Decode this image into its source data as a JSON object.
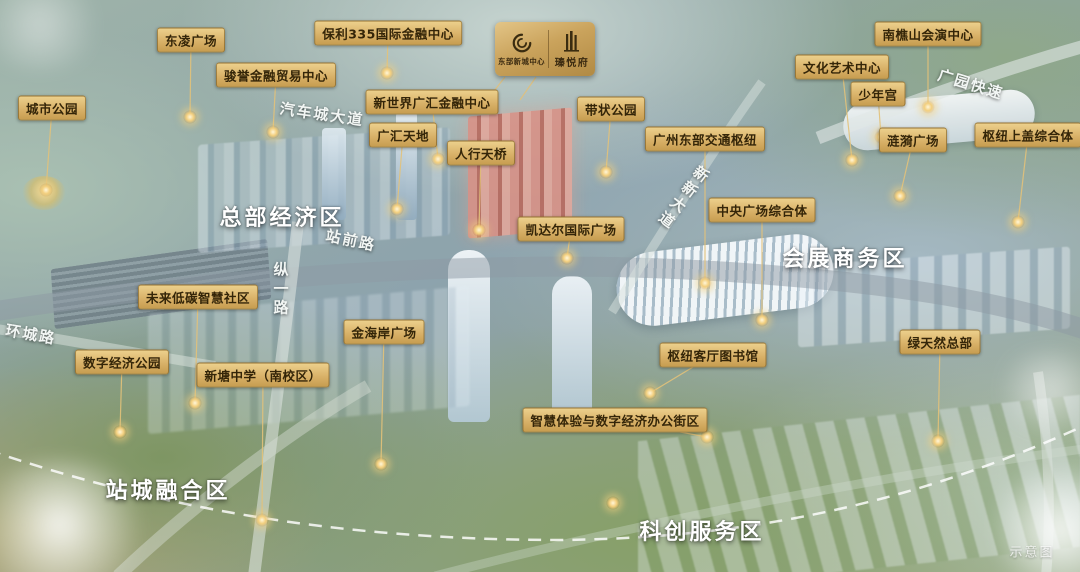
{
  "watermark": "示意图",
  "badge": {
    "left_name": "东部新城中心",
    "right_name": "瑧悦府"
  },
  "zones": [
    {
      "label": "总部经济区",
      "x": 282,
      "y": 216
    },
    {
      "label": "会展商务区",
      "x": 845,
      "y": 257
    },
    {
      "label": "站城融合区",
      "x": 168,
      "y": 489
    },
    {
      "label": "科创服务区",
      "x": 702,
      "y": 530
    }
  ],
  "roads": [
    {
      "label": "汽车城大道",
      "x": 322,
      "y": 114,
      "rotate": 8,
      "vertical": false
    },
    {
      "label": "站前路",
      "x": 351,
      "y": 240,
      "rotate": 12,
      "vertical": false
    },
    {
      "label": "纵一路",
      "x": 281,
      "y": 290,
      "rotate": 0,
      "vertical": true
    },
    {
      "label": "环城路",
      "x": 31,
      "y": 334,
      "rotate": 10,
      "vertical": false
    },
    {
      "label": "广园快速",
      "x": 971,
      "y": 84,
      "rotate": 17,
      "vertical": false
    },
    {
      "label": "新新大道",
      "x": 683,
      "y": 198,
      "rotate": 37,
      "vertical": true
    }
  ],
  "landmarks": [
    {
      "label": "城市公园",
      "lx": 52,
      "ly": 108,
      "dx": 46,
      "dy": 190
    },
    {
      "label": "东凌广场",
      "lx": 191,
      "ly": 40,
      "dx": 190,
      "dy": 117
    },
    {
      "label": "骏誉金融贸易中心",
      "lx": 276,
      "ly": 75,
      "dx": 273,
      "dy": 132
    },
    {
      "label": "保利335国际金融中心",
      "lx": 388,
      "ly": 33,
      "dx": 387,
      "dy": 73
    },
    {
      "label": "新世界广汇金融中心",
      "lx": 432,
      "ly": 102,
      "dx": 438,
      "dy": 159
    },
    {
      "label": "广汇天地",
      "lx": 403,
      "ly": 135,
      "dx": 397,
      "dy": 209
    },
    {
      "label": "人行天桥",
      "lx": 481,
      "ly": 153,
      "dx": 479,
      "dy": 230
    },
    {
      "label": "带状公园",
      "lx": 611,
      "ly": 109,
      "dx": 606,
      "dy": 172
    },
    {
      "label": "广州东部交通枢纽",
      "lx": 705,
      "ly": 139,
      "dx": 705,
      "dy": 283
    },
    {
      "label": "凯达尔国际广场",
      "lx": 571,
      "ly": 229,
      "dx": 567,
      "dy": 258
    },
    {
      "label": "中央广场综合体",
      "lx": 762,
      "ly": 210,
      "dx": 762,
      "dy": 320
    },
    {
      "label": "文化艺术中心",
      "lx": 842,
      "ly": 67,
      "dx": 852,
      "dy": 160
    },
    {
      "label": "南樵山会演中心",
      "lx": 928,
      "ly": 34,
      "dx": 928,
      "dy": 107
    },
    {
      "label": "少年宫",
      "lx": 878,
      "ly": 94,
      "dx": 881,
      "dy": 137
    },
    {
      "label": "涟漪广场",
      "lx": 913,
      "ly": 140,
      "dx": 900,
      "dy": 196
    },
    {
      "label": "枢纽上盖综合体",
      "lx": 1028,
      "ly": 135,
      "dx": 1018,
      "dy": 222
    },
    {
      "label": "未来低碳智慧社区",
      "lx": 198,
      "ly": 297,
      "dx": 195,
      "dy": 403
    },
    {
      "label": "数字经济公园",
      "lx": 122,
      "ly": 362,
      "dx": 120,
      "dy": 432
    },
    {
      "label": "新塘中学（南校区）",
      "lx": 263,
      "ly": 375,
      "dx": 262,
      "dy": 520
    },
    {
      "label": "金海岸广场",
      "lx": 384,
      "ly": 332,
      "dx": 381,
      "dy": 464
    },
    {
      "label": "枢纽客厅图书馆",
      "lx": 713,
      "ly": 355,
      "dx": 650,
      "dy": 393
    },
    {
      "label": "智慧体验与数字经济办公街区",
      "lx": 615,
      "ly": 420,
      "dx": 707,
      "dy": 437
    },
    {
      "label": "绿天然总部",
      "lx": 940,
      "ly": 342,
      "dx": 938,
      "dy": 441
    }
  ],
  "extra_markers": [
    {
      "x": 613,
      "y": 503
    }
  ],
  "colors": {
    "label_bg": "#d9b269",
    "label_text": "#342508",
    "leader_line": "#e3c27a",
    "zone_text": "#ffffff",
    "badge_gold": "#caa35c",
    "boundary_dash": "#ffffff"
  }
}
